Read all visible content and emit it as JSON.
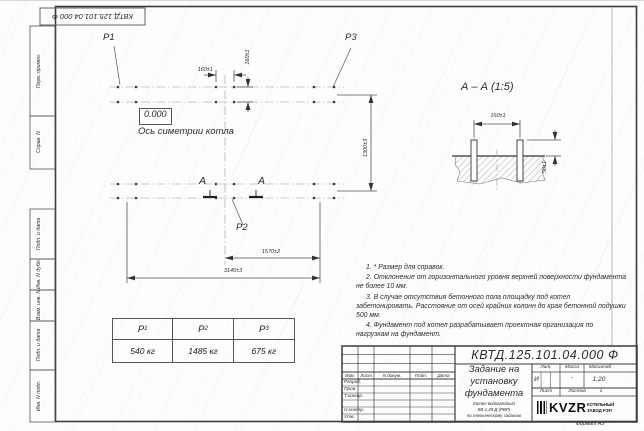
{
  "stamp": {
    "doc_number_rotated": "КВТД.125.101.04.000 Ф"
  },
  "margin": {
    "labels": [
      "Перв. примен.",
      "Справ. N",
      "Подп. и дата",
      "Инв. N дубл.",
      "Взам. инв. N",
      "Подп. и дата",
      "Инв. N подл."
    ]
  },
  "plan": {
    "level_mark": "0.000",
    "axis_label": "Ось симетрии котла",
    "load_labels": {
      "p1": "P1",
      "p2": "P2",
      "p3": "P3"
    },
    "section_letter": "А",
    "dims": {
      "d160": "160±1",
      "d1300": "1300±3",
      "d1570": "1570±2",
      "d3145": "3145±3"
    }
  },
  "section_view": {
    "title": "А – А (1:5)",
    "dims": {
      "d160": "160±1",
      "d50": "50±1"
    }
  },
  "notes": {
    "items": [
      "1. * Размер для справок.",
      "2. Отклонение от горизонтального уровня верхней поверхности фундамента не более 10 мм.",
      "3. В случае отсутствия бетонного пола площадку под котел забетонировать. Расстояние от осей крайних колонн до края бетонной подушки 500 мм.",
      "4. Фундамент под котел разрабатывает проектная организация по нагрузкам на фундамент."
    ]
  },
  "load_table": {
    "headers": [
      {
        "base": "P",
        "sub": "1"
      },
      {
        "base": "P",
        "sub": "2"
      },
      {
        "base": "P",
        "sub": "3"
      }
    ],
    "values": [
      "540 кг",
      "1485 кг",
      "675 кг"
    ]
  },
  "title_block": {
    "doc_number": "КВТД.125.101.04.000 Ф",
    "rev_cols": [
      "Изм.",
      "Лист",
      "N докум.",
      "Подп.",
      "Дата"
    ],
    "roles": [
      "Разраб.",
      "Пров.",
      "Т.контр.",
      "Н.контр.",
      "Утв."
    ],
    "name_lines": [
      "Задание на",
      "установку",
      "фундамента"
    ],
    "subtitle_lines": [
      "Котел водогрейный",
      "КВ-1,45 Д (РВР)",
      "по техническому заданию"
    ],
    "lit_label": "Лит.",
    "mass_label": "Масса",
    "scale_label": "Масштаб",
    "lit_value": "И",
    "mass_value": "-",
    "scale_value": "1:20",
    "sheet_label": "Лист",
    "sheets_label": "Листов",
    "sheets_value": "1",
    "logo_text": "KVZR",
    "logo_caption_1": "КОТЕЛЬНЫЙ",
    "logo_caption_2": "ЗАВОД РЭП",
    "format_label": "Формат А3"
  }
}
